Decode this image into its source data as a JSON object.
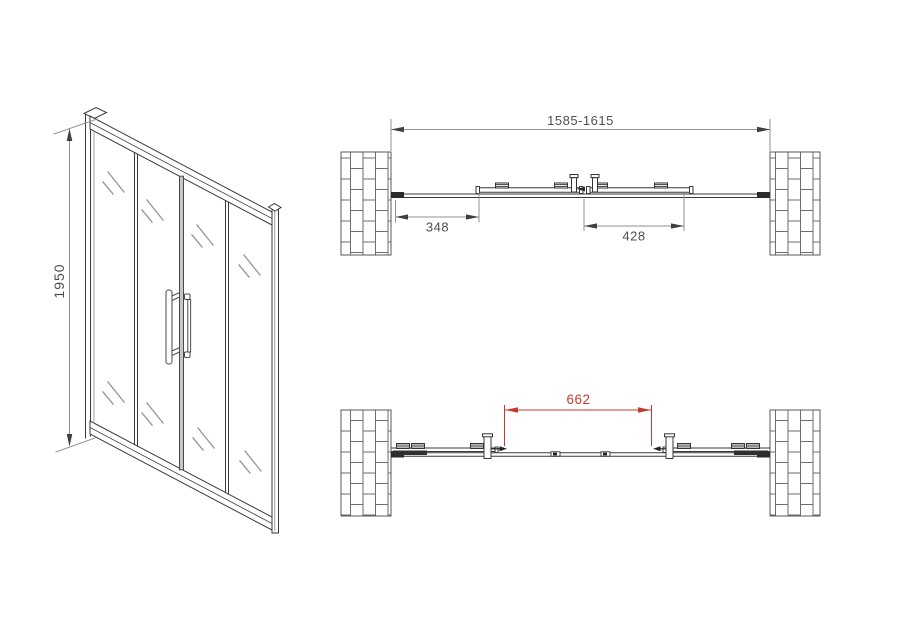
{
  "drawing": {
    "front_view": {
      "height_label": "1950"
    },
    "plan_view_closed": {
      "overall_width_label": "1585-1615",
      "left_panel_label": "348",
      "sliding_panel_label": "428"
    },
    "plan_view_open": {
      "opening_label": "662"
    },
    "colors": {
      "drawing_line": "#3a3a3a",
      "dimension_line": "#909090",
      "dimension_text": "#4f4f4f",
      "wall_hatch": "#6e6e6e",
      "highlight_red": "#c23b2e",
      "background": "#ffffff"
    }
  }
}
